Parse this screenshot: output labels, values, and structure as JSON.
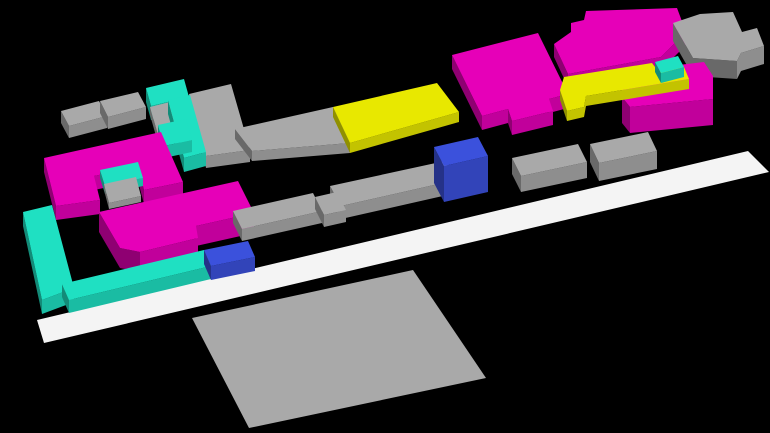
{
  "scene": {
    "title": "3d-city-blocks-render",
    "canvas": {
      "width": 770,
      "height": 433,
      "background": "#000000"
    },
    "palette": {
      "magenta": "#E600B8",
      "cyan": "#1FE0C2",
      "yellow": "#E8E800",
      "gray": "#A9A9A9",
      "blue": "#3B51DC",
      "white": "#F4F4F4",
      "ground": "#A9A9A9"
    },
    "shading": {
      "top": 1.0,
      "front": 0.84,
      "side": 0.62
    },
    "blocks": [
      {
        "name": "ground-plane",
        "color": "ground",
        "h": 0,
        "top": [
          [
            413,
            270
          ],
          [
            486,
            378
          ],
          [
            249,
            428
          ],
          [
            192,
            318
          ]
        ]
      },
      {
        "name": "road-strip",
        "color": "white",
        "h": 0,
        "top": [
          [
            37,
            320
          ],
          [
            748,
            151
          ],
          [
            769,
            172
          ],
          [
            44,
            343
          ]
        ]
      },
      {
        "name": "building-gray-topleft-a",
        "color": "gray",
        "h": 12,
        "top": [
          [
            61,
            111
          ],
          [
            99,
            101
          ],
          [
            107,
            116
          ],
          [
            69,
            126
          ]
        ]
      },
      {
        "name": "building-gray-topleft-b",
        "color": "gray",
        "h": 12,
        "top": [
          [
            100,
            101
          ],
          [
            138,
            92
          ],
          [
            146,
            107
          ],
          [
            108,
            117
          ]
        ]
      },
      {
        "name": "building-cyan-c-top",
        "color": "cyan",
        "h": 14,
        "top": [
          [
            146,
            88
          ],
          [
            184,
            79
          ],
          [
            189,
            97
          ],
          [
            151,
            106
          ]
        ]
      },
      {
        "name": "building-gray-mid-left",
        "color": "gray",
        "h": 12,
        "top": [
          [
            189,
            94
          ],
          [
            231,
            84
          ],
          [
            250,
            150
          ],
          [
            206,
            156
          ]
        ]
      },
      {
        "name": "building-gray-c-inner",
        "color": "gray",
        "h": 8,
        "top": [
          [
            150,
            107
          ],
          [
            170,
            102
          ],
          [
            178,
            130
          ],
          [
            158,
            135
          ]
        ]
      },
      {
        "name": "building-cyan-c-column",
        "color": "cyan",
        "h": 14,
        "top": [
          [
            168,
            100
          ],
          [
            190,
            95
          ],
          [
            206,
            152
          ],
          [
            184,
            158
          ]
        ]
      },
      {
        "name": "building-cyan-c-foot",
        "color": "cyan",
        "h": 12,
        "top": [
          [
            158,
            125
          ],
          [
            186,
            119
          ],
          [
            192,
            140
          ],
          [
            164,
            146
          ]
        ]
      },
      {
        "name": "bar-gray-upper",
        "color": "gray",
        "h": 10,
        "top": [
          [
            235,
            129
          ],
          [
            333,
            107
          ],
          [
            350,
            143
          ],
          [
            252,
            151
          ]
        ]
      },
      {
        "name": "bar-yellow-upper",
        "color": "yellow",
        "h": 10,
        "top": [
          [
            333,
            107
          ],
          [
            437,
            83
          ],
          [
            459,
            112
          ],
          [
            350,
            143
          ]
        ]
      },
      {
        "name": "building-magenta-center-top",
        "color": "magenta",
        "h": 14,
        "top": [
          [
            452,
            55
          ],
          [
            538,
            33
          ],
          [
            568,
            94
          ],
          [
            549,
            99
          ],
          [
            553,
            111
          ],
          [
            512,
            121
          ],
          [
            508,
            109
          ],
          [
            482,
            116
          ]
        ]
      },
      {
        "name": "building-magenta-topright",
        "color": "magenta",
        "h": 13,
        "top": [
          [
            554,
            44
          ],
          [
            571,
            32
          ],
          [
            571,
            23
          ],
          [
            584,
            20
          ],
          [
            586,
            11
          ],
          [
            677,
            8
          ],
          [
            686,
            32
          ],
          [
            661,
            57
          ],
          [
            568,
            74
          ]
        ]
      },
      {
        "name": "building-gray-topright",
        "color": "gray",
        "h": 18,
        "top": [
          [
            673,
            23
          ],
          [
            700,
            14
          ],
          [
            733,
            12
          ],
          [
            742,
            32
          ],
          [
            757,
            28
          ],
          [
            764,
            46
          ],
          [
            741,
            53
          ],
          [
            737,
            61
          ],
          [
            693,
            58
          ]
        ]
      },
      {
        "name": "building-magenta-right-mid",
        "color": "magenta",
        "h": 26,
        "top": [
          [
            622,
            80
          ],
          [
            636,
            70
          ],
          [
            704,
            62
          ],
          [
            713,
            76
          ],
          [
            713,
            99
          ],
          [
            630,
            107
          ],
          [
            622,
            97
          ]
        ]
      },
      {
        "name": "bar-yellow-right",
        "color": "yellow",
        "h": 10,
        "top": [
          [
            560,
            90
          ],
          [
            564,
            77
          ],
          [
            652,
            63
          ],
          [
            658,
            71
          ],
          [
            684,
            67
          ],
          [
            689,
            79
          ],
          [
            586,
            96
          ],
          [
            584,
            107
          ],
          [
            567,
            111
          ]
        ]
      },
      {
        "name": "building-cyan-small-right",
        "color": "cyan",
        "h": 10,
        "top": [
          [
            655,
            62
          ],
          [
            678,
            56
          ],
          [
            684,
            67
          ],
          [
            661,
            73
          ]
        ]
      },
      {
        "name": "building-magenta-court-u",
        "color": "magenta",
        "h": 14,
        "top": [
          [
            44,
            158
          ],
          [
            161,
            132
          ],
          [
            183,
            182
          ],
          [
            144,
            190
          ],
          [
            138,
            167
          ],
          [
            94,
            176
          ],
          [
            100,
            200
          ],
          [
            56,
            206
          ]
        ]
      },
      {
        "name": "building-cyan-courtyard",
        "color": "cyan",
        "h": 8,
        "top": [
          [
            100,
            170
          ],
          [
            138,
            162
          ],
          [
            143,
            178
          ],
          [
            105,
            186
          ]
        ]
      },
      {
        "name": "building-gray-courtyard",
        "color": "gray",
        "h": 6,
        "top": [
          [
            104,
            184
          ],
          [
            136,
            177
          ],
          [
            141,
            196
          ],
          [
            109,
            203
          ]
        ]
      },
      {
        "name": "building-magenta-lower-left",
        "color": "magenta",
        "h": 20,
        "top": [
          [
            99,
            212
          ],
          [
            238,
            181
          ],
          [
            254,
            213
          ],
          [
            196,
            226
          ],
          [
            198,
            238
          ],
          [
            140,
            252
          ],
          [
            120,
            248
          ]
        ]
      },
      {
        "name": "bar-gray-center-a",
        "color": "gray",
        "h": 12,
        "top": [
          [
            233,
            211
          ],
          [
            313,
            193
          ],
          [
            322,
            211
          ],
          [
            242,
            229
          ]
        ]
      },
      {
        "name": "bar-gray-center-c",
        "color": "gray",
        "h": 13,
        "top": [
          [
            330,
            186
          ],
          [
            445,
            161
          ],
          [
            456,
            180
          ],
          [
            341,
            206
          ]
        ]
      },
      {
        "name": "bar-gray-center-b",
        "color": "gray",
        "h": 12,
        "top": [
          [
            315,
            197
          ],
          [
            337,
            192
          ],
          [
            346,
            210
          ],
          [
            324,
            215
          ]
        ]
      },
      {
        "name": "building-blue-center",
        "color": "blue",
        "h": 36,
        "top": [
          [
            434,
            147
          ],
          [
            478,
            137
          ],
          [
            488,
            156
          ],
          [
            444,
            166
          ]
        ]
      },
      {
        "name": "building-gray-right-a",
        "color": "gray",
        "h": 16,
        "top": [
          [
            512,
            158
          ],
          [
            578,
            144
          ],
          [
            587,
            162
          ],
          [
            521,
            176
          ]
        ]
      },
      {
        "name": "building-gray-right-b",
        "color": "gray",
        "h": 18,
        "top": [
          [
            590,
            144
          ],
          [
            648,
            132
          ],
          [
            657,
            151
          ],
          [
            599,
            163
          ]
        ]
      },
      {
        "name": "building-cyan-l-arm",
        "color": "cyan",
        "h": 14,
        "top": [
          [
            23,
            212
          ],
          [
            52,
            205
          ],
          [
            74,
            288
          ],
          [
            42,
            300
          ]
        ]
      },
      {
        "name": "building-cyan-l-bar",
        "color": "cyan",
        "h": 13,
        "top": [
          [
            62,
            284
          ],
          [
            204,
            250
          ],
          [
            211,
            266
          ],
          [
            69,
            300
          ]
        ]
      },
      {
        "name": "building-blue-left",
        "color": "blue",
        "h": 14,
        "top": [
          [
            204,
            250
          ],
          [
            248,
            241
          ],
          [
            255,
            257
          ],
          [
            211,
            266
          ]
        ]
      }
    ]
  }
}
